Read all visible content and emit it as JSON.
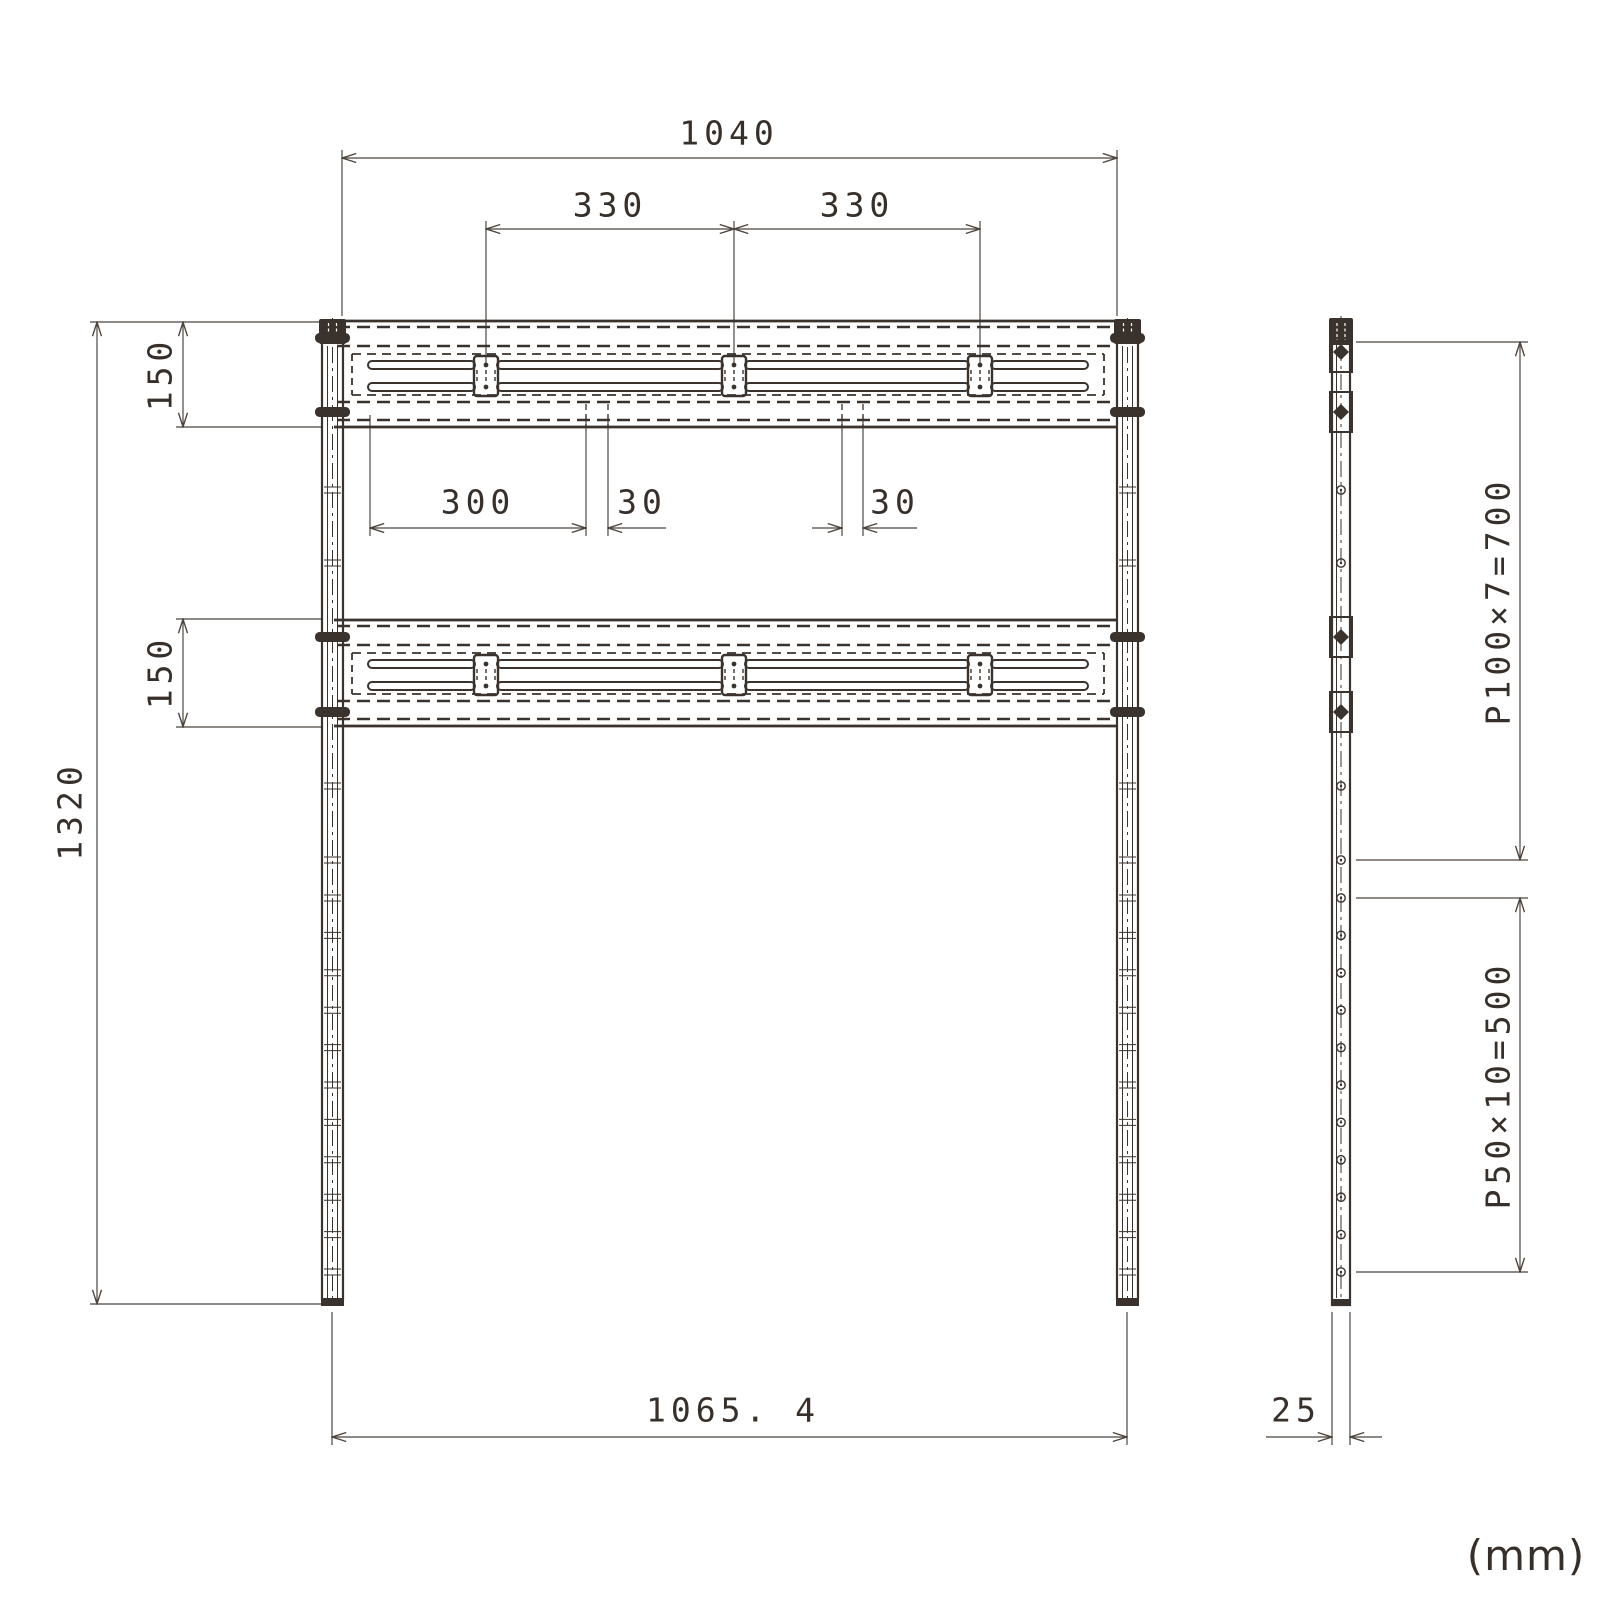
{
  "drawing": {
    "units_note": "(mm)",
    "front_view": {
      "dimensions": {
        "rail_length_top": "1040",
        "bracket_pitch_left": "330",
        "bracket_pitch_right": "330",
        "upper_rail_height": "150",
        "lower_rail_height": "150",
        "overall_height": "1320",
        "slot_length": "300",
        "slot_gap_left": "30",
        "slot_gap_right": "30",
        "overall_width": "1065. 4"
      }
    },
    "side_view": {
      "dimensions": {
        "upper_hole_pitch": "P100×7=700",
        "lower_hole_pitch": "P50×10=500",
        "post_depth": "25"
      }
    }
  }
}
